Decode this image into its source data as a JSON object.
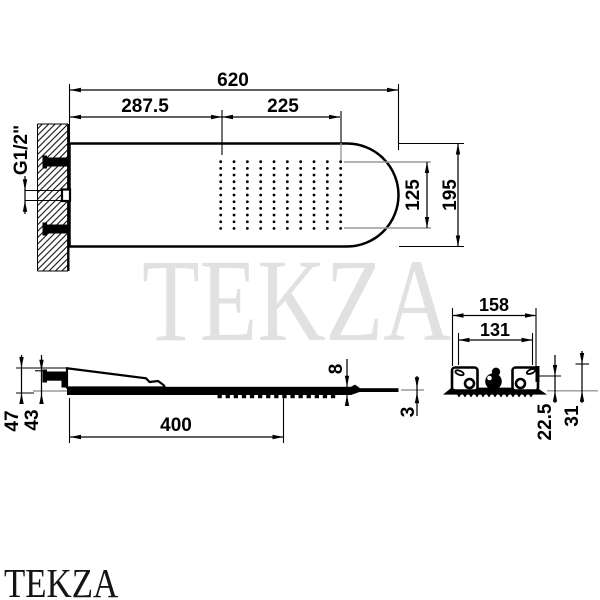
{
  "colors": {
    "line": "#000000",
    "extension_gray": "#9a9a9a",
    "watermark_center": "#e1e1e1",
    "watermark_corner": "#141414"
  },
  "watermarks": {
    "center_text": "TEKZA",
    "corner_text": "TEKZA"
  },
  "top_view": {
    "labels": {
      "overall_length": "620",
      "left_section": "287.5",
      "spray_section": "225",
      "spray_field_height": "125",
      "overall_height": "195",
      "inlet_thread": "G1/2\""
    },
    "nozzle_grid": {
      "cols": 10,
      "rows": 11
    }
  },
  "side_view": {
    "labels": {
      "total_height": "47",
      "body_height": "43",
      "length": "400",
      "plate_thickness": "8",
      "edge_thickness": "3"
    },
    "nozzle_dashes": 15
  },
  "end_view": {
    "labels": {
      "outer_width": "158",
      "inner_width": "131",
      "upper_depth": "22.5",
      "total_depth": "31"
    },
    "teeth": 13
  }
}
